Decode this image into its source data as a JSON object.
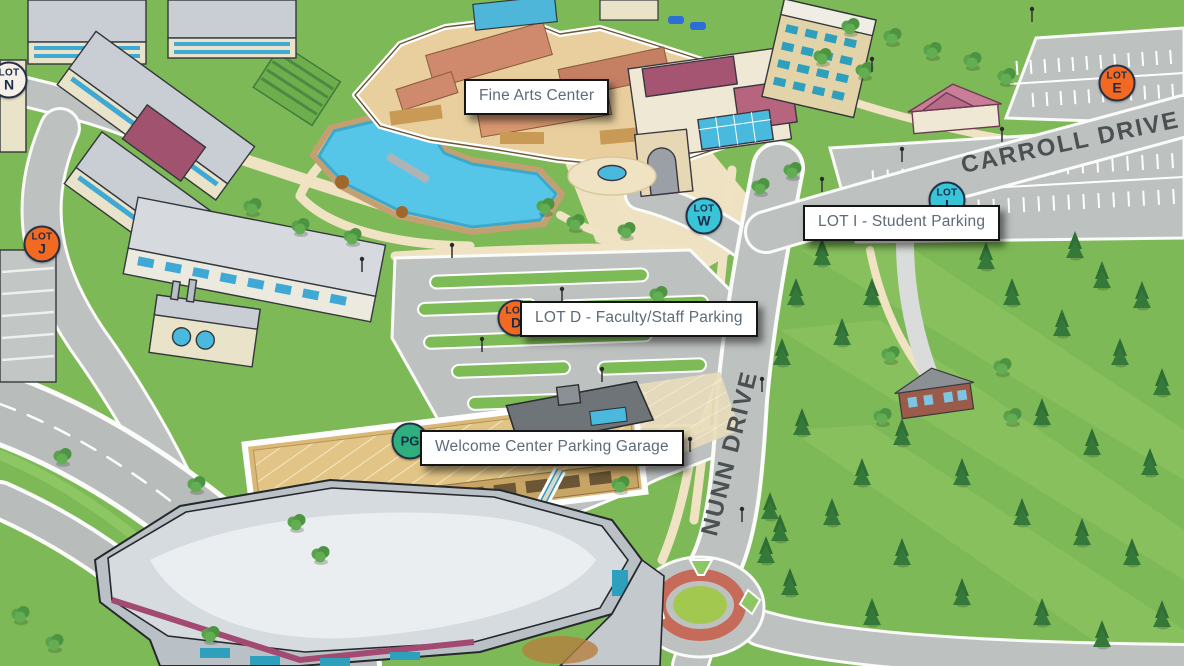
{
  "map": {
    "description": "Illustrated 3D campus map",
    "roads": [
      {
        "id": "carroll-drive",
        "name": "CARROLL DRIVE"
      },
      {
        "id": "nunn-drive",
        "name": "NUNN DRIVE"
      }
    ],
    "labels": [
      {
        "id": "fine-arts-center",
        "text": "Fine Arts Center",
        "x": 464,
        "y": 79
      },
      {
        "id": "lot-i-student-parking",
        "text": "LOT I - Student Parking",
        "x": 803,
        "y": 205
      },
      {
        "id": "lot-d-faculty-staff-parking",
        "text": "LOT D - Faculty/Staff Parking",
        "x": 520,
        "y": 301
      },
      {
        "id": "welcome-center-parking-garage",
        "text": "Welcome Center Parking Garage",
        "x": 420,
        "y": 430
      }
    ],
    "markers": [
      {
        "id": "lot-n",
        "line1": "LOT",
        "line2": "N",
        "color": "#f5f1e8",
        "x": 9,
        "y": 80
      },
      {
        "id": "lot-j",
        "line1": "LOT",
        "line2": "J",
        "color": "#f26a21",
        "x": 42,
        "y": 244
      },
      {
        "id": "lot-e",
        "line1": "LOT",
        "line2": "E",
        "color": "#f26a21",
        "x": 1117,
        "y": 83
      },
      {
        "id": "lot-w",
        "line1": "LOT",
        "line2": "W",
        "color": "#38c5d8",
        "x": 704,
        "y": 216
      },
      {
        "id": "lot-i",
        "line1": "LOT",
        "line2": "I",
        "color": "#38c5d8",
        "x": 947,
        "y": 200
      },
      {
        "id": "lot-d",
        "line1": "LOT",
        "line2": "D",
        "color": "#f26a21",
        "x": 516,
        "y": 318
      },
      {
        "id": "pg",
        "line1": "PG",
        "line2": "",
        "color": "#2fae7e",
        "x": 410,
        "y": 441
      }
    ],
    "colors": {
      "grass": "#7db956",
      "road": "#bdc1c0",
      "water": "#55c6e8",
      "sidewalk": "#efe3c4",
      "label_text": "#5d6b78",
      "road_label_text": "#4b5152",
      "marker_border": "#233048",
      "selected_building_outline": "#ffffff",
      "orange_marker": "#f26a21",
      "teal_marker": "#38c5d8",
      "green_marker": "#2fae7e"
    }
  }
}
